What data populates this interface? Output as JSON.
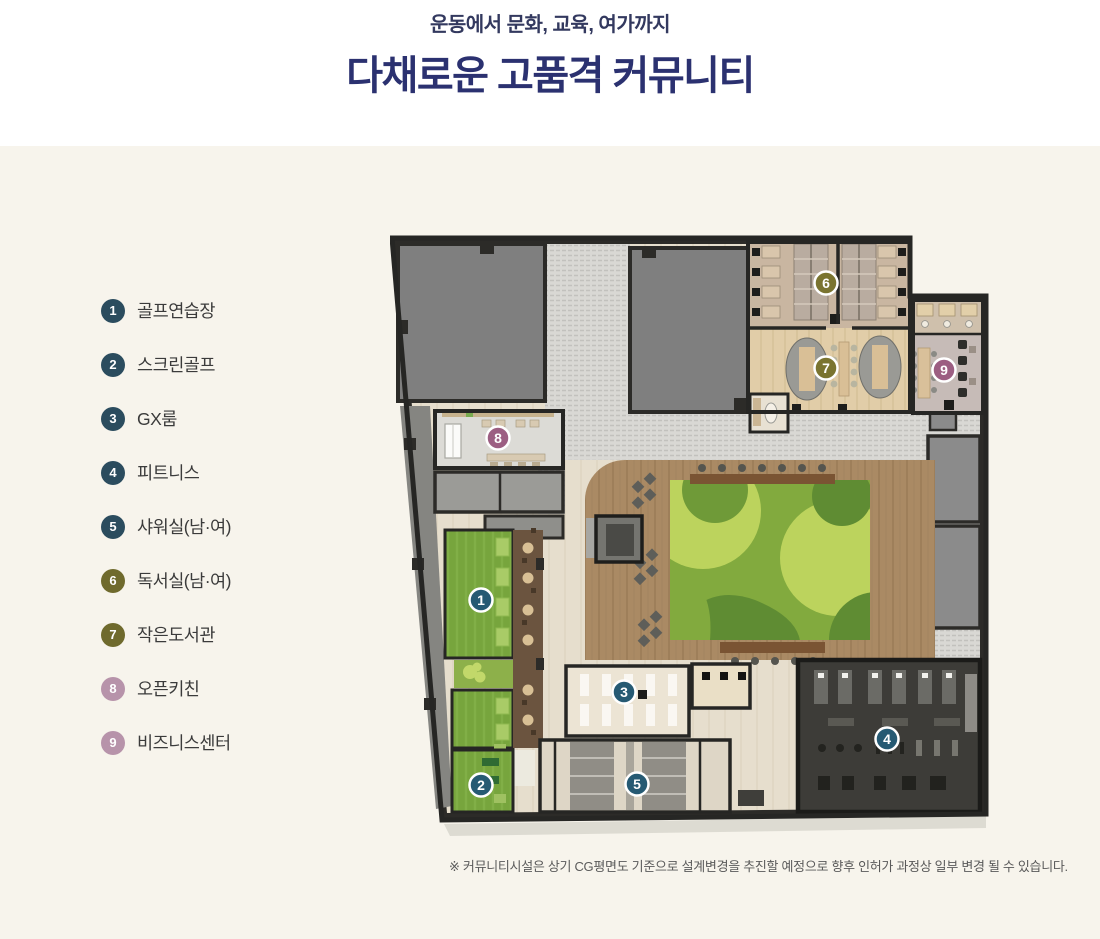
{
  "header": {
    "subtitle": "운동에서 문화, 교육, 여가까지",
    "title": "다채로운 고품격 커뮤니티"
  },
  "legend": {
    "items": [
      {
        "number": "1",
        "label": "골프연습장",
        "color": "#2b4c5e"
      },
      {
        "number": "2",
        "label": "스크린골프",
        "color": "#2b4c5e"
      },
      {
        "number": "3",
        "label": "GX룸",
        "color": "#2b4c5e"
      },
      {
        "number": "4",
        "label": "피트니스",
        "color": "#2b4c5e"
      },
      {
        "number": "5",
        "label": "샤워실(남·여)",
        "color": "#2b4c5e"
      },
      {
        "number": "6",
        "label": "독서실(남·여)",
        "color": "#6f6a2d"
      },
      {
        "number": "7",
        "label": "작은도서관",
        "color": "#6f6a2d"
      },
      {
        "number": "8",
        "label": "오픈키친",
        "color": "#b793aa"
      },
      {
        "number": "9",
        "label": "비즈니스센터",
        "color": "#b793aa"
      }
    ]
  },
  "plan": {
    "markers": [
      {
        "number": "1",
        "color": "#265a73"
      },
      {
        "number": "2",
        "color": "#265a73"
      },
      {
        "number": "3",
        "color": "#265a73"
      },
      {
        "number": "4",
        "color": "#265a73"
      },
      {
        "number": "5",
        "color": "#265a73"
      },
      {
        "number": "6",
        "color": "#7a7430"
      },
      {
        "number": "7",
        "color": "#7a7430"
      },
      {
        "number": "8",
        "color": "#9c5e82"
      },
      {
        "number": "9",
        "color": "#9c5e82"
      }
    ]
  },
  "footnote": "※ 커뮤니티시설은 상기 CG평면도 기준으로 설계변경을 추진할 예정으로 향후 인허가 과정상 일부 변경 될 수 있습니다.",
  "theme": {
    "page_background": "#f7f4ec",
    "header_background": "#ffffff",
    "title_color": "#2b3170",
    "subtitle_color": "#33395f",
    "legend_teal": "#2b4c5e",
    "legend_olive": "#6f6a2d",
    "legend_mauve": "#b793aa",
    "marker_teal": "#265a73",
    "marker_olive": "#7a7430",
    "marker_mauve": "#9c5e82"
  }
}
